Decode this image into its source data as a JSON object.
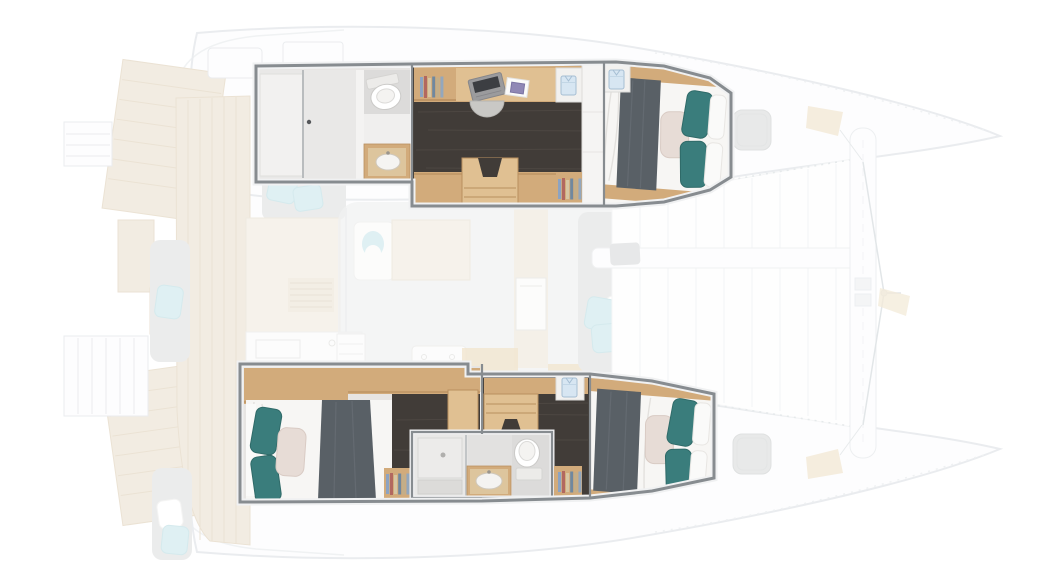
{
  "meta": {
    "figure_type": "catamaran-yacht-floor-plan",
    "view": "top-down",
    "orientation": "bow-right",
    "visible_text": ""
  },
  "palette": {
    "page_bg": "#ffffff",
    "ghost_stroke": "#d9dee2",
    "ghost_fill": "#fdfdfe",
    "ghost_gray": "#dcdede",
    "teak": "#e9decb",
    "teak_line": "#dbccb2",
    "ghost_beige": "#efe8db",
    "ghost_blue": "#c5e4ea",
    "frame": "#878c90",
    "frame_halo": "#f0f1f2",
    "room_base": "#e7e5e3",
    "shower_floor": "#e9e8e7",
    "head_floor": "#dcdbda",
    "wall": "#f4f3f2",
    "wood": "#d2ab7b",
    "wood_light": "#e0c092",
    "wood_edge": "#b98f5f",
    "dark_floor": "#413c38",
    "grain": "#57504b",
    "mattress": "#f7f6f4",
    "sheet_line": "#e3e1de",
    "blanket": "#596066",
    "blanket_hi": "#6f757c",
    "teal": "#3a7d7c",
    "teal_dark": "#2f6a68",
    "blush": "#e7dcd6",
    "white_pillow": "#fafaf9",
    "laptop_body": "#9b9b9d",
    "laptop_screen": "#3c3e42",
    "tramp_fill": "#fefefe",
    "hatch": "#d6d8d8",
    "cleat_beige": "#ead9ba"
  },
  "inventory": {
    "upper_hull": {
      "sections": [
        {
          "name": "aft-head",
          "features": [
            "shower-room",
            "sliding-door",
            "toilet",
            "sink-vanity"
          ]
        },
        {
          "name": "office",
          "features": [
            "bookshelf",
            "desk",
            "laptop",
            "notebook",
            "stool",
            "shirt-locker",
            "wardrobe",
            "companionway-steps",
            "bookshelf-aft"
          ]
        },
        {
          "name": "forward-cabin",
          "features": [
            "double-bed",
            "dark-blanket",
            "teal-pillows",
            "blush-pillow",
            "shirt-locker"
          ]
        }
      ]
    },
    "lower_hull": {
      "sections": [
        {
          "name": "aft-cabin",
          "features": [
            "double-bed",
            "dark-blanket",
            "teal-pillows",
            "blush-pillow",
            "wood-header"
          ]
        },
        {
          "name": "mid-head",
          "features": [
            "shower",
            "sink-vanity",
            "toilet",
            "bookshelves",
            "companionway-steps"
          ]
        },
        {
          "name": "forward-cabin",
          "features": [
            "double-bed",
            "dark-blanket",
            "teal-pillows",
            "blush-pillow",
            "shirt-locker"
          ]
        }
      ]
    },
    "exterior_ghosted": [
      "swim-platforms",
      "boarding-ladders",
      "cockpit-teak",
      "cockpit-benches",
      "cockpit-pillows",
      "galley-blocks",
      "salon",
      "foredeck-lounge",
      "trampoline",
      "longeron-beam",
      "forward-crossbeam",
      "forestay-bridle",
      "deck-hatches",
      "bow-cleats"
    ]
  }
}
